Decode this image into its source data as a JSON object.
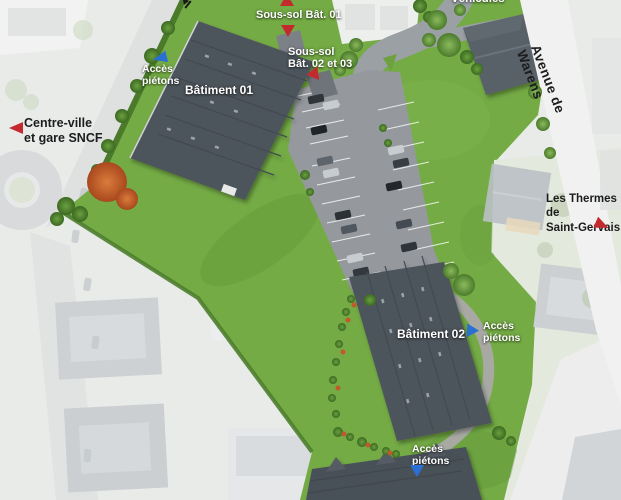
{
  "site_plan": {
    "labels": {
      "vehicules": "Véhicules",
      "sous_sol_bat_01": "Sous-sol Bât. 01",
      "sous_sol_bat_02_03": "Sous-sol\nBât. 02 et 03",
      "acces_pietons_nw": "Accès\npiétons",
      "batiment_01": "Bâtiment 01",
      "centre_ville": "Centre-ville\net gare SNCF",
      "avenue_de_warens": "Avenue de Warens",
      "les_thermes": "Les Thermes de\nSaint-Gervais",
      "batiment_02": "Bâtiment 02",
      "acces_pietons_e": "Accès\npiétons",
      "acces_pietons_s": "Accès\npiétons"
    },
    "markers": {
      "red_triangle_color": "#c32a2e",
      "blue_triangle_color": "#2a6fd2"
    },
    "colors": {
      "grass": "#74ab45",
      "roof": "#4d545c",
      "road": "#989da1",
      "faded_background": "#e9ebe9",
      "orange_tree": "#c4602c"
    }
  }
}
